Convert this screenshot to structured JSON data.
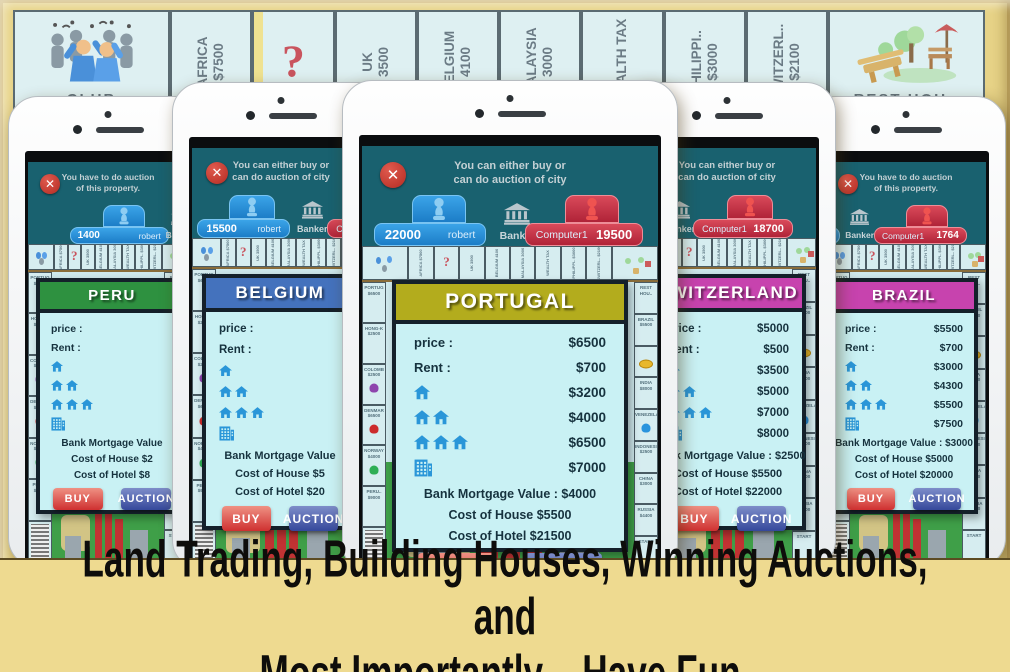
{
  "caption": {
    "line1": "Land Trading, Building Houses, Winning Auctions, and",
    "line2": "Most Importantly – Have Fun."
  },
  "board": {
    "corner_left": "CLUB",
    "corner_right": "REST HOU..",
    "tiles": [
      {
        "name": "AFRICA",
        "price": "$7500"
      },
      {
        "name": "?",
        "price": "",
        "question": true
      },
      {
        "name": "UK",
        "price": "3500"
      },
      {
        "name": "BELGIUM",
        "price": "4100"
      },
      {
        "name": "MALAYSIA",
        "price": "3000"
      },
      {
        "name": "WEALTH TAX",
        "price": ""
      },
      {
        "name": "PHILIPPI..",
        "price": "$3000"
      },
      {
        "name": "SWITZERL..",
        "price": "$2100"
      }
    ]
  },
  "mini_board": {
    "left_tiles": [
      {
        "name": "PORTUG",
        "price": "$6500"
      },
      {
        "name": "HONG-K",
        "price": "$2500"
      },
      {
        "name": "COLOMB",
        "price": "$2500",
        "pawn": "#8e44ad"
      },
      {
        "name": "DENMAR",
        "price": "$6500",
        "pawn": "#cc2b2b"
      },
      {
        "name": "NORWAY",
        "price": "$4000",
        "pawn": "#2fae55"
      },
      {
        "name": "PERU..",
        "price": "$9000"
      },
      {
        "name": "JAIL",
        "price": "",
        "jail": true
      }
    ],
    "right_tiles": [
      {
        "name": "REST HOU..",
        "price": ""
      },
      {
        "name": "BRAZIL",
        "price": "$5500"
      },
      {
        "name": "",
        "price": "",
        "coin": true
      },
      {
        "name": "INDIA",
        "price": "$8000"
      },
      {
        "name": "VENEZELAN..",
        "price": "",
        "pawn": "#2a94dd"
      },
      {
        "name": "INDONESIA",
        "price": "$2500"
      },
      {
        "name": "CHINA",
        "price": "$3000"
      },
      {
        "name": "RUSSIA",
        "price": "$4400"
      },
      {
        "name": "START",
        "price": ""
      }
    ]
  },
  "phones": [
    {
      "title": "PERU",
      "message": [
        "You have to do auction",
        "of this property."
      ],
      "players": {
        "left_amount": "1400",
        "left_name": "robert",
        "banker": "Banker",
        "right_name": "Computer1",
        "right_amount": ""
      },
      "card": {
        "title": "PERU",
        "header_color": "#2e9140",
        "rows": [
          {
            "label": "price :",
            "value": ""
          },
          {
            "label": "Rent :",
            "value": ""
          },
          {
            "houses": 1,
            "value": ""
          },
          {
            "houses": 2,
            "value": ""
          },
          {
            "houses": 3,
            "value": ""
          },
          {
            "hotel": true,
            "value": ""
          }
        ],
        "lines": [
          "Bank Mortgage Value",
          "Cost of House $2",
          "Cost of Hotel $8"
        ],
        "buy_label": "BUY",
        "auction_label": "AUCTION"
      }
    },
    {
      "title": "BELGIUM",
      "message": [
        "You can either buy or",
        "can do auction of city"
      ],
      "players": {
        "left_amount": "15500",
        "left_name": "robert",
        "banker": "Banker",
        "right_name": "Computer1",
        "right_amount": ""
      },
      "card": {
        "title": "BELGIUM",
        "header_color": "#4472bd",
        "rows": [
          {
            "label": "price :",
            "value": ""
          },
          {
            "label": "Rent :",
            "value": ""
          },
          {
            "houses": 1,
            "value": ""
          },
          {
            "houses": 2,
            "value": ""
          },
          {
            "houses": 3,
            "value": ""
          },
          {
            "hotel": true,
            "value": ""
          }
        ],
        "lines": [
          "Bank Mortgage Value",
          "Cost of House $5",
          "Cost of Hotel $20"
        ],
        "buy_label": "BUY",
        "auction_label": "AUCTION"
      }
    },
    {
      "title": "PORTUGAL",
      "message": [
        "You can either buy or",
        "can do auction of city"
      ],
      "players": {
        "left_amount": "22000",
        "left_name": "robert",
        "banker": "Banker",
        "right_name": "Computer1",
        "right_amount": "19500"
      },
      "card": {
        "title": "PORTUGAL",
        "header_color": "#b3ac1d",
        "rows": [
          {
            "label": "price :",
            "value": "$6500"
          },
          {
            "label": "Rent :",
            "value": "$700"
          },
          {
            "houses": 1,
            "value": "$3200"
          },
          {
            "houses": 2,
            "value": "$4000"
          },
          {
            "houses": 3,
            "value": "$6500"
          },
          {
            "hotel": true,
            "value": "$7000"
          }
        ],
        "lines": [
          "Bank Mortgage Value : $4000",
          "Cost of House $5500",
          "Cost of Hotel $21500"
        ],
        "buy_label": "BUY",
        "auction_label": "AUCTION"
      }
    },
    {
      "title": "SWITZERLAND",
      "message": [
        "You can either buy or",
        "can do auction of city"
      ],
      "players": {
        "left_amount": "",
        "left_name": "robert",
        "banker": "Banker",
        "right_name": "Computer1",
        "right_amount": "18700"
      },
      "card": {
        "title": "SWITZERLAND",
        "header_color": "#c743ae",
        "rows": [
          {
            "label": "price :",
            "value": "$5000"
          },
          {
            "label": "Rent :",
            "value": "$500"
          },
          {
            "houses": 1,
            "value": "$3500"
          },
          {
            "houses": 2,
            "value": "$5000"
          },
          {
            "houses": 3,
            "value": "$7000"
          },
          {
            "hotel": true,
            "value": "$8000"
          }
        ],
        "lines": [
          "Bank Mortgage Value : $2500",
          "Cost of House $5500",
          "Cost of Hotel $22000"
        ],
        "buy_label": "BUY",
        "auction_label": "AUCTION"
      }
    },
    {
      "title": "BRAZIL",
      "message": [
        "You have to do auction",
        "of this property."
      ],
      "players": {
        "left_amount": "",
        "left_name": "robert",
        "banker": "Banker",
        "right_name": "Computer1",
        "right_amount": "1764"
      },
      "card": {
        "title": "BRAZIL",
        "header_color": "#c743ae",
        "rows": [
          {
            "label": "price :",
            "value": "$5500"
          },
          {
            "label": "Rent :",
            "value": "$700"
          },
          {
            "houses": 1,
            "value": "$3000"
          },
          {
            "houses": 2,
            "value": "$4300"
          },
          {
            "houses": 3,
            "value": "$5500"
          },
          {
            "hotel": true,
            "value": "$7500"
          }
        ],
        "lines": [
          "Bank Mortgage Value : $3000",
          "Cost of House $5000",
          "Cost of Hotel $20000"
        ],
        "buy_label": "BUY",
        "auction_label": "AUCTION"
      }
    }
  ],
  "colors": {
    "frame": "#e7d387",
    "screen_teal": "#19616f",
    "card_bg": "#c9f1f4",
    "buy_red": "#cf3030",
    "auction_blue": "#35489b",
    "tab_blue": "#1c7dc7",
    "tab_red": "#b02338",
    "board_bg": "#dff0f3",
    "house_blue": "#2a96d8"
  }
}
